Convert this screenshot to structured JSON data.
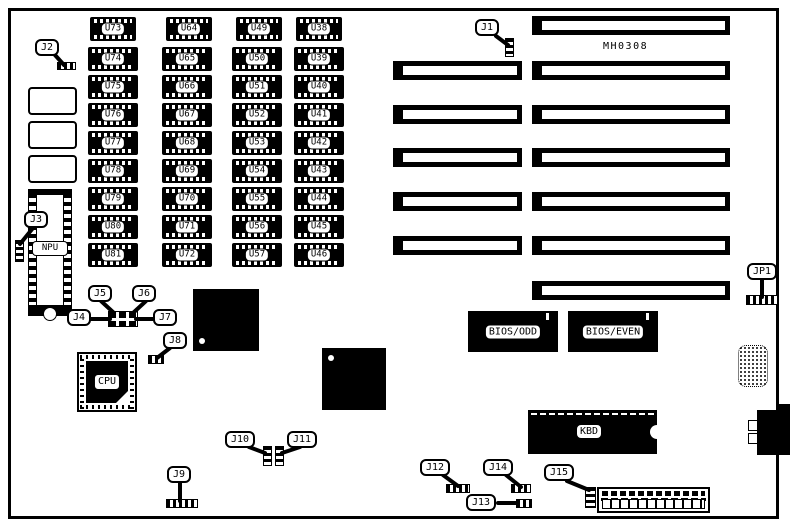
{
  "board": {
    "part_number": "MH0308"
  },
  "memory": {
    "columns": [
      {
        "chips": [
          "U73",
          "U74",
          "U75",
          "U76",
          "U77",
          "U78",
          "U79",
          "U80",
          "U81"
        ]
      },
      {
        "chips": [
          "U64",
          "U65",
          "U66",
          "U67",
          "U68",
          "U69",
          "U70",
          "U71",
          "U72"
        ]
      },
      {
        "chips": [
          "U49",
          "U50",
          "U51",
          "U52",
          "U53",
          "U54",
          "U55",
          "U56",
          "U57"
        ]
      },
      {
        "chips": [
          "U38",
          "U39",
          "U40",
          "U41",
          "U42",
          "U43",
          "U44",
          "U45",
          "U46"
        ]
      }
    ]
  },
  "chips": {
    "cpu": "CPU",
    "npu": "NPU",
    "kbd": "KBD",
    "bios_odd": "BIOS/ODD",
    "bios_even": "BIOS/EVEN"
  },
  "jumpers": {
    "j1": "J1",
    "j2": "J2",
    "j3": "J3",
    "j4": "J4",
    "j5": "J5",
    "j6": "J6",
    "j7": "J7",
    "j8": "J8",
    "j9": "J9",
    "j10": "J10",
    "j11": "J11",
    "j12": "J12",
    "j13": "J13",
    "j14": "J14",
    "j15": "J15",
    "jp1": "JP1"
  },
  "colors": {
    "ink": "#000000",
    "paper": "#ffffff"
  }
}
